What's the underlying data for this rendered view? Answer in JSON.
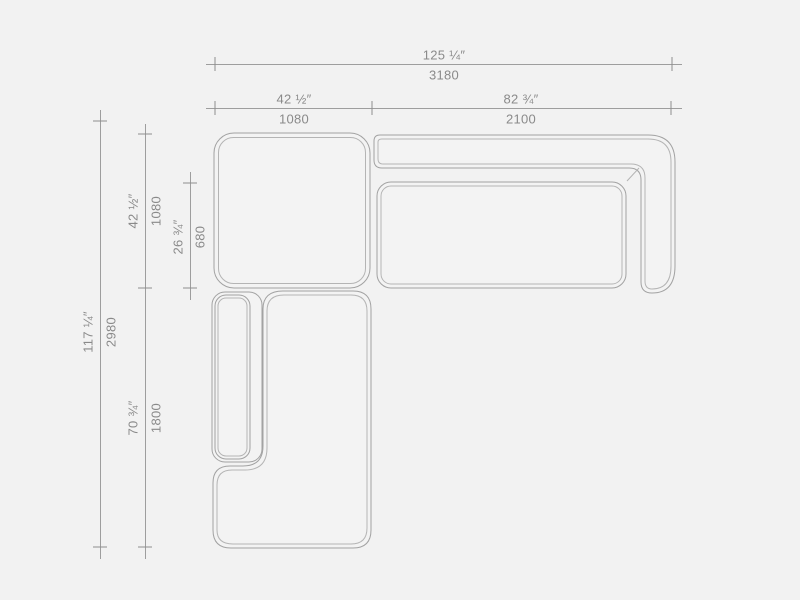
{
  "diagram": {
    "title": "sectional-sofa-top-view-dimension-drawing",
    "units": [
      "inches",
      "millimeters"
    ],
    "dimensions": {
      "overall_width": {
        "inches": "125 ¼″",
        "mm": "3180"
      },
      "left_module_width": {
        "inches": "42 ½″",
        "mm": "1080"
      },
      "right_module_width": {
        "inches": "82 ¾″",
        "mm": "2100"
      },
      "overall_depth": {
        "inches": "117 ¼″",
        "mm": "2980"
      },
      "left_module_depth": {
        "inches": "42 ½″",
        "mm": "1080"
      },
      "seat_depth": {
        "inches": "26 ¾″",
        "mm": "680"
      },
      "chaise_length": {
        "inches": "70 ¾″",
        "mm": "1800"
      }
    },
    "parts": [
      "ottoman-module-top-left",
      "right-sofa-backrest-and-arm",
      "right-sofa-seat-cushion",
      "chaise-module-bottom",
      "chaise-left-arm"
    ],
    "colors": {
      "background": "#f2f2f2",
      "shape_fill": "#f3f3f3",
      "outline": "#a2a2a2",
      "outline_light": "#b4b4b4",
      "dim_line": "#9e9e9e",
      "text": "#8a8a8a"
    }
  }
}
